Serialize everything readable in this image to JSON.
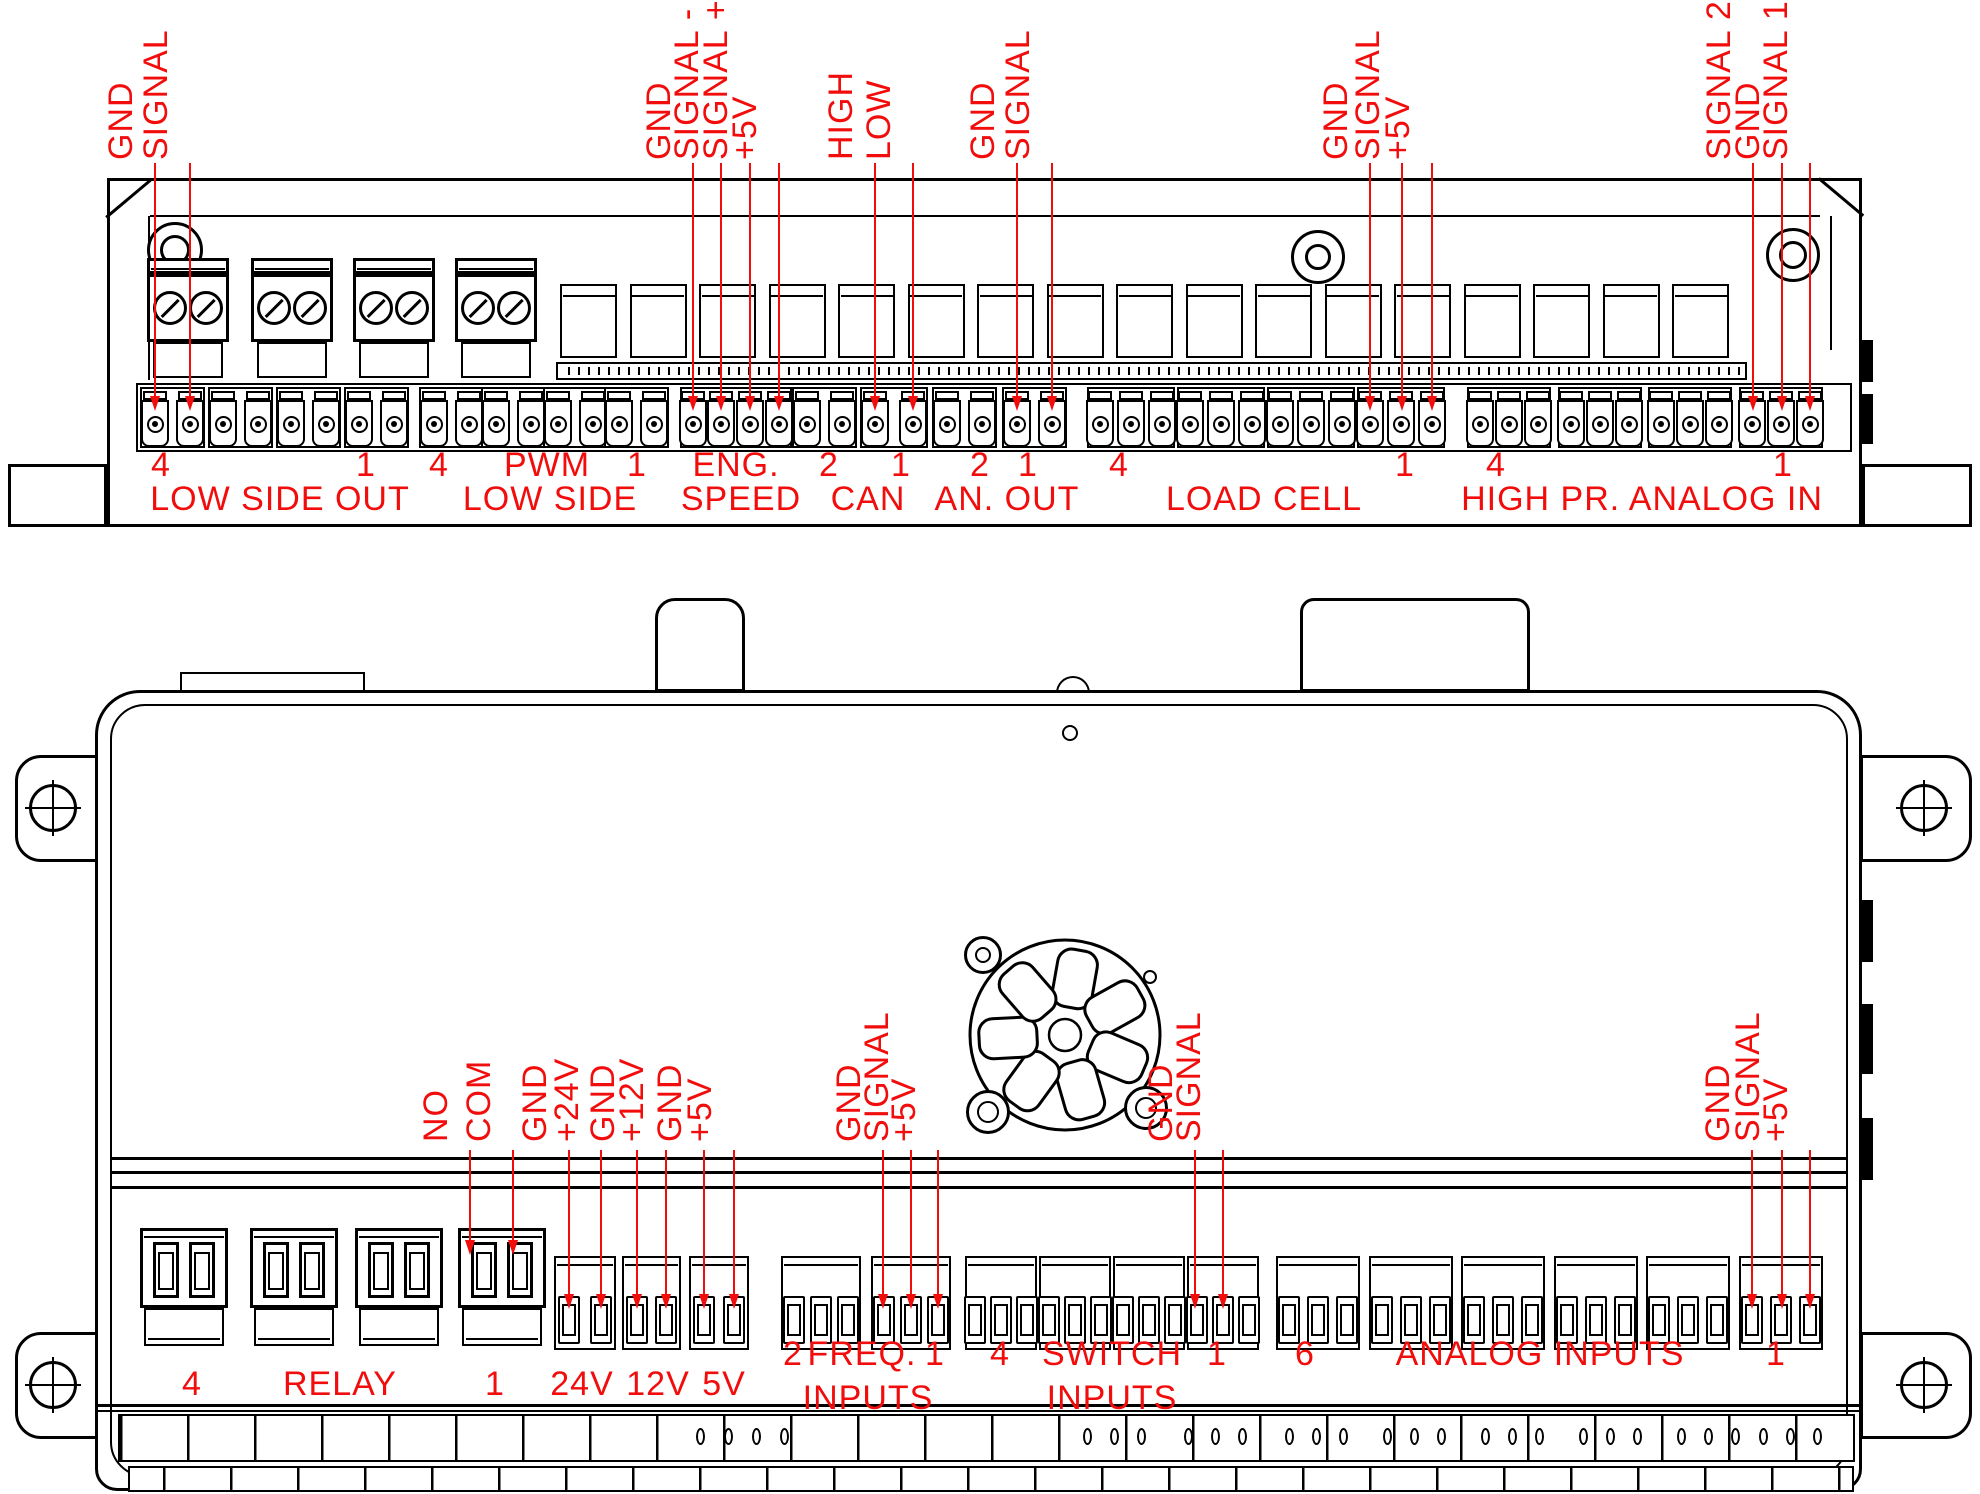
{
  "colors": {
    "accent_red": "#f20d0d",
    "line_black": "#000000",
    "background": "#ffffff"
  },
  "top_view": {
    "pin_labels": [
      "GND",
      "SIGNAL",
      "GND",
      "SIGNAL -",
      "SIGNAL +",
      "+5V",
      "HIGH",
      "LOW",
      "GND",
      "SIGNAL",
      "GND",
      "SIGNAL",
      "+5V",
      "SIGNAL 2",
      "GND",
      "SIGNAL 1"
    ],
    "channel_numbers": [
      "4",
      "1",
      "4",
      "PWM",
      "1",
      "ENG.",
      "2",
      "1",
      "2",
      "1",
      "4",
      "1",
      "4",
      "1"
    ],
    "section_names": [
      "LOW SIDE OUT",
      "LOW SIDE",
      "SPEED",
      "CAN",
      "AN. OUT",
      "LOAD CELL",
      "HIGH PR. ANALOG IN"
    ]
  },
  "bottom_view": {
    "pin_labels": [
      "NO",
      "COM",
      "GND",
      "+24V",
      "GND",
      "+12V",
      "GND",
      "+5V",
      "GND",
      "SIGNAL",
      "+5V",
      "GND",
      "SIGNAL",
      "GND",
      "SIGNAL",
      "+5V"
    ],
    "section_row1": [
      "4",
      "RELAY",
      "1",
      "24V",
      "12V",
      "5V",
      "2",
      "FREQ.",
      "1",
      "4",
      "SWITCH",
      "1",
      "6",
      "ANALOG INPUTS",
      "1"
    ],
    "section_row2": [
      "INPUTS",
      "INPUTS"
    ]
  }
}
